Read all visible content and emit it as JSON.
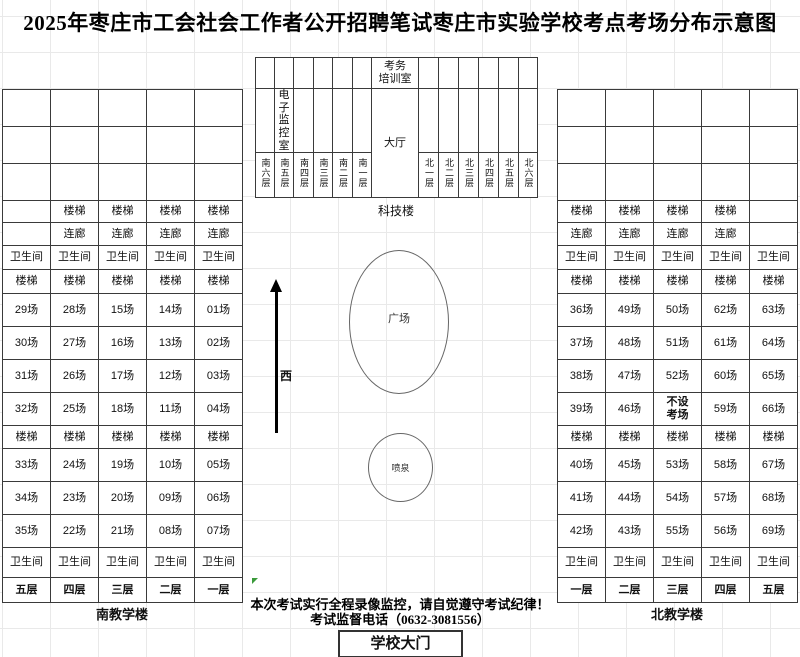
{
  "title": "2025年枣庄市工会社会工作者公开招聘笔试枣庄市实验学校考点考场分布示意图",
  "labels": {
    "stairs": "楼梯",
    "corridor": "连廊",
    "toilet": "卫生间"
  },
  "south": {
    "label": "南教学楼",
    "floors": [
      "五层",
      "四层",
      "三层",
      "二层",
      "一层"
    ],
    "rooms_upper": [
      [
        "29场",
        "28场",
        "15场",
        "14场",
        "01场"
      ],
      [
        "30场",
        "27场",
        "16场",
        "13场",
        "02场"
      ],
      [
        "31场",
        "26场",
        "17场",
        "12场",
        "03场"
      ],
      [
        "32场",
        "25场",
        "18场",
        "11场",
        "04场"
      ]
    ],
    "rooms_lower": [
      [
        "33场",
        "24场",
        "19场",
        "10场",
        "05场"
      ],
      [
        "34场",
        "23场",
        "20场",
        "09场",
        "06场"
      ],
      [
        "35场",
        "22场",
        "21场",
        "08场",
        "07场"
      ]
    ]
  },
  "north": {
    "label": "北教学楼",
    "floors": [
      "一层",
      "二层",
      "三层",
      "四层",
      "五层"
    ],
    "rooms_upper": [
      [
        "36场",
        "49场",
        "50场",
        "62场",
        "63场"
      ],
      [
        "37场",
        "48场",
        "51场",
        "61场",
        "64场"
      ],
      [
        "38场",
        "47场",
        "52场",
        "60场",
        "65场"
      ],
      [
        "39场",
        "46场",
        "不设\n考场",
        "59场",
        "66场"
      ]
    ],
    "rooms_lower": [
      [
        "40场",
        "45场",
        "53场",
        "58场",
        "67场"
      ],
      [
        "41场",
        "44场",
        "54场",
        "57场",
        "68场"
      ],
      [
        "42场",
        "43场",
        "55场",
        "56场",
        "69场"
      ]
    ]
  },
  "science": {
    "label": "科技楼",
    "training_room": "考务\n培训室",
    "monitor_room": "电子\n监控\n室",
    "hall": "大厅",
    "south_floors": [
      "南六层",
      "南五层",
      "南四层",
      "南三层",
      "南二层",
      "南一层"
    ],
    "north_floors": [
      "北一层",
      "北二层",
      "北三层",
      "北四层",
      "北五层",
      "北六层"
    ]
  },
  "plaza": "广场",
  "fountain": "喷泉",
  "west": "西",
  "notice": {
    "line1": "本次考试实行全程录像监控，请自觉遵守考试纪律！",
    "line2": "考试监督电话（0632-3081556）"
  },
  "gate": "学校大门",
  "colors": {
    "highlight_bg": "#FFFF00",
    "highlight_text": "#FF0000",
    "cell_gray": "#D9D9D9",
    "grid_border": "#3A3A3A"
  }
}
